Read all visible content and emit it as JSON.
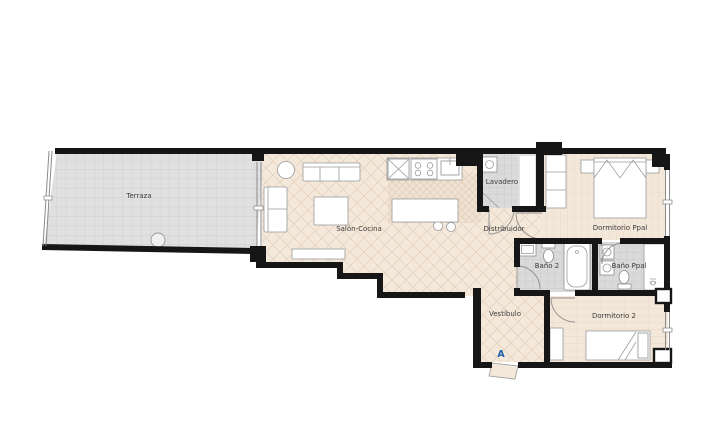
{
  "plan": {
    "type": "apartment-floor-plan",
    "rooms": [
      {
        "id": "terraza",
        "label": "Terraza"
      },
      {
        "id": "salon-cocina",
        "label": "Salón-Cocina"
      },
      {
        "id": "lavadero",
        "label": "Lavadero"
      },
      {
        "id": "distribuidor",
        "label": "Distribuidor"
      },
      {
        "id": "dormitorio-ppal",
        "label": "Dormitorio Ppal"
      },
      {
        "id": "bano-2",
        "label": "Baño 2"
      },
      {
        "id": "bano-ppal",
        "label": "Baño Ppal"
      },
      {
        "id": "vestibulo",
        "label": "Vestíbulo"
      },
      {
        "id": "dormitorio-2",
        "label": "Dormitorio 2"
      }
    ],
    "entrance_marker": {
      "label": "A",
      "color": "#1f5fa8"
    },
    "colors": {
      "wall": "#161616",
      "interior_floor": "#f4e8da",
      "interior_hatch": "#e4d1be",
      "kitchen_floor": "#f0e2d2",
      "tile_floor": "#dadada",
      "tile_line": "#c5c5c5",
      "terrace_floor": "#e0e0e0",
      "terrace_grid": "#cccccc",
      "label_text": "#3c3c3c"
    }
  }
}
